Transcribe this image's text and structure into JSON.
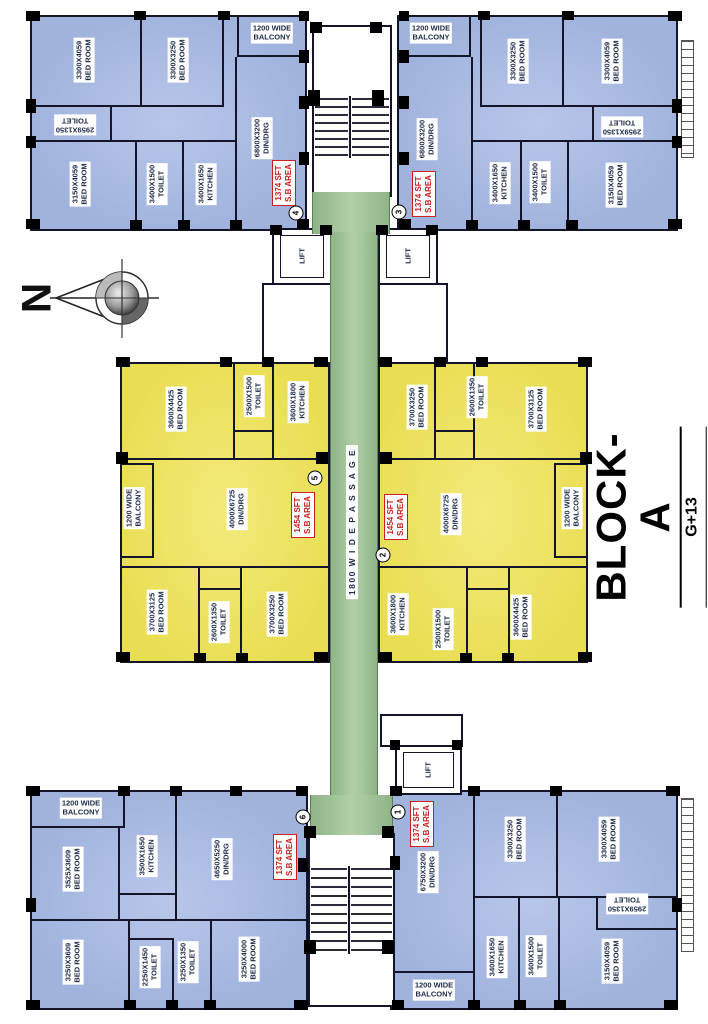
{
  "block": {
    "name": "BLOCK-A",
    "floors": "G+13"
  },
  "compass": {
    "north": "N"
  },
  "passage": {
    "label": "1800 W I D E  P A S S A G E"
  },
  "lifts": {
    "label": "LIFT"
  },
  "colors": {
    "unit_blue": "#a0b3dd",
    "unit_yellow": "#e9de52",
    "passage_green": "#a2c598",
    "wall": "#14142a",
    "label_text": "#1c2947",
    "area_red": "#c81e1e"
  },
  "units": {
    "unit4": {
      "no": "4",
      "area_line1": "1374 SFT",
      "area_line2": "S.B AREA",
      "rooms": {
        "balcony": {
          "dim": "1200 WIDE",
          "name": "BALCONY"
        },
        "bed1": {
          "dim": "3300X4059",
          "name": "BED ROOM"
        },
        "bed2": {
          "dim": "3300X3250",
          "name": "BED ROOM"
        },
        "toilet1": {
          "dim": "2959X1350",
          "name": "TOILET"
        },
        "din": {
          "dim": "6800X3200",
          "name": "DIN/DRG"
        },
        "bed3": {
          "dim": "3150X4059",
          "name": "BED ROOM"
        },
        "toilet2": {
          "dim": "3400X1500",
          "name": "TOILET"
        },
        "kitchen": {
          "dim": "3400X1650",
          "name": "KITCHEN"
        }
      }
    },
    "unit3": {
      "no": "3",
      "area_line1": "1374 SFT",
      "area_line2": "S.B AREA",
      "rooms": {
        "balcony": {
          "dim": "1200 WIDE",
          "name": "BALCONY"
        },
        "bed1": {
          "dim": "3300X3250",
          "name": "BED ROOM"
        },
        "bed2": {
          "dim": "3300X4059",
          "name": "BED ROOM"
        },
        "toilet1": {
          "dim": "2959X1350",
          "name": "TOILET"
        },
        "din": {
          "dim": "6800X3200",
          "name": "DIN/DRG"
        },
        "kitchen": {
          "dim": "3400X1650",
          "name": "KITCHEN"
        },
        "toilet2": {
          "dim": "3400X1500",
          "name": "TOILET"
        },
        "bed3": {
          "dim": "3150X4059",
          "name": "BED ROOM"
        }
      }
    },
    "unit5": {
      "no": "5",
      "area_line1": "1454 SFT",
      "area_line2": "S.B AREA",
      "rooms": {
        "bed1": {
          "dim": "3600X4425",
          "name": "BED ROOM"
        },
        "toilet1": {
          "dim": "2500X1500",
          "name": "TOILET"
        },
        "kitchen": {
          "dim": "3600X1800",
          "name": "KITCHEN"
        },
        "balcony": {
          "dim": "1200 WIDE",
          "name": "BALCONY"
        },
        "din": {
          "dim": "4000X6725",
          "name": "DIN/DRG"
        },
        "bed2": {
          "dim": "3700X3125",
          "name": "BED ROOM"
        },
        "toilet2": {
          "dim": "2600X1350",
          "name": "TOILET"
        },
        "bed3": {
          "dim": "3700X3250",
          "name": "BED ROOM"
        }
      }
    },
    "unit2": {
      "no": "2",
      "area_line1": "1454 SFT",
      "area_line2": "S.B AREA",
      "rooms": {
        "bed1": {
          "dim": "3700X3250",
          "name": "BED ROOM"
        },
        "toilet1": {
          "dim": "2600X1350",
          "name": "TOILET"
        },
        "bed2": {
          "dim": "3700X3125",
          "name": "BED ROOM"
        },
        "din": {
          "dim": "4000X6725",
          "name": "DIN/DRG"
        },
        "balcony": {
          "dim": "1200 WIDE",
          "name": "BALCONY"
        },
        "kitchen": {
          "dim": "3600X1800",
          "name": "KITCHEN"
        },
        "toilet2": {
          "dim": "2500X1500",
          "name": "TOILET"
        },
        "bed3": {
          "dim": "3600X4425",
          "name": "BED ROOM"
        }
      }
    },
    "unit6": {
      "no": "6",
      "area_line1": "1374 SFT",
      "area_line2": "S.B AREA",
      "rooms": {
        "balcony": {
          "dim": "1200 WIDE",
          "name": "BALCONY"
        },
        "bed1": {
          "dim": "3525X3609",
          "name": "BED ROOM"
        },
        "kitchen": {
          "dim": "3500X1650",
          "name": "KITCHEN"
        },
        "din": {
          "dim": "4650X5250",
          "name": "DIN/DRG"
        },
        "bed2": {
          "dim": "3250X3609",
          "name": "BED ROOM"
        },
        "toilet1": {
          "dim": "2250X1450",
          "name": "TOILET"
        },
        "toilet2": {
          "dim": "3250X1350",
          "name": "TOILET"
        },
        "bed3": {
          "dim": "3250X4000",
          "name": "BED ROOM"
        }
      }
    },
    "unit1": {
      "no": "1",
      "area_line1": "1374 SFT",
      "area_line2": "S.B AREA",
      "rooms": {
        "din": {
          "dim": "6750X3200",
          "name": "DIN/DRG"
        },
        "bed1": {
          "dim": "3300X3250",
          "name": "BED ROOM"
        },
        "bed2": {
          "dim": "3300X4059",
          "name": "BED ROOM"
        },
        "toilet1": {
          "dim": "2959X1350",
          "name": "TOILET"
        },
        "kitchen": {
          "dim": "3400X1650",
          "name": "KITCHEN"
        },
        "toilet2": {
          "dim": "3400X1500",
          "name": "TOILET"
        },
        "bed3": {
          "dim": "3150X4059",
          "name": "BED ROOM"
        },
        "balcony": {
          "dim": "1200 WIDE",
          "name": "BALCONY"
        }
      }
    }
  }
}
